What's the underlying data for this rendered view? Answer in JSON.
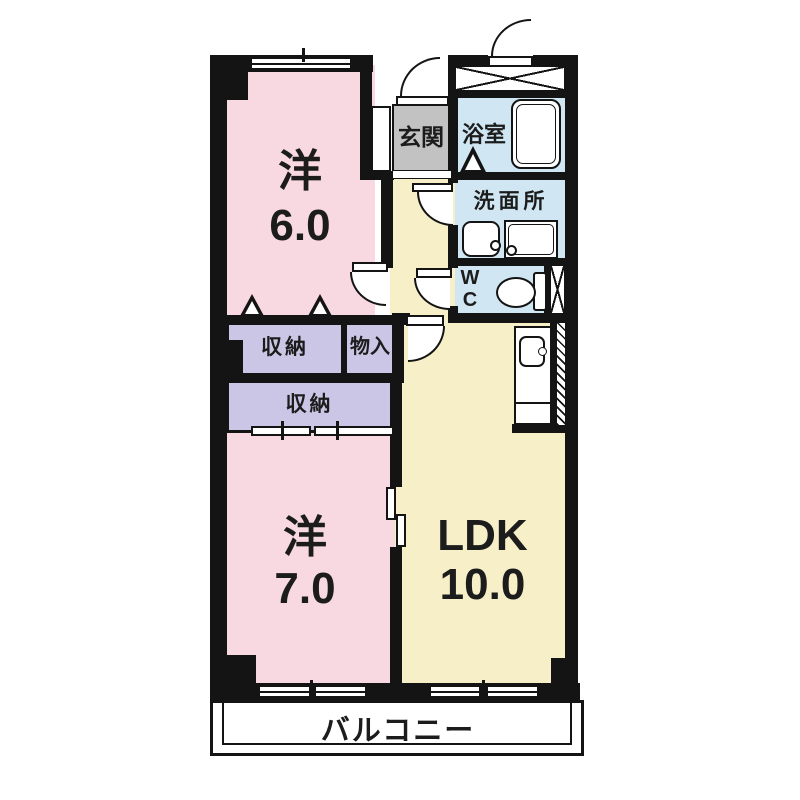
{
  "plan": {
    "title": "apartment-floor-plan",
    "rooms": {
      "western6": {
        "name": "洋",
        "area": "6.0"
      },
      "western7": {
        "name": "洋",
        "area": "7.0"
      },
      "ldk": {
        "name": "LDK",
        "area": "10.0"
      },
      "entrance": {
        "name": "玄関"
      },
      "bathroom": {
        "name": "浴室"
      },
      "washroom": {
        "name": "洗面所"
      },
      "wc": {
        "line1": "W",
        "line2": "C"
      },
      "storage_upper": {
        "name": "収納"
      },
      "closet": {
        "name": "物入"
      },
      "storage_lower": {
        "name": "収納"
      },
      "balcony": {
        "name": "バルコニー"
      }
    },
    "colors": {
      "room_pink": "#F8D9E2",
      "room_yellow": "#F6EFC8",
      "wet_blue": "#D0E7F3",
      "closet_purple": "#CBC6E6",
      "entrance_gray": "#C2C2C2",
      "wall_black": "#141414"
    }
  }
}
